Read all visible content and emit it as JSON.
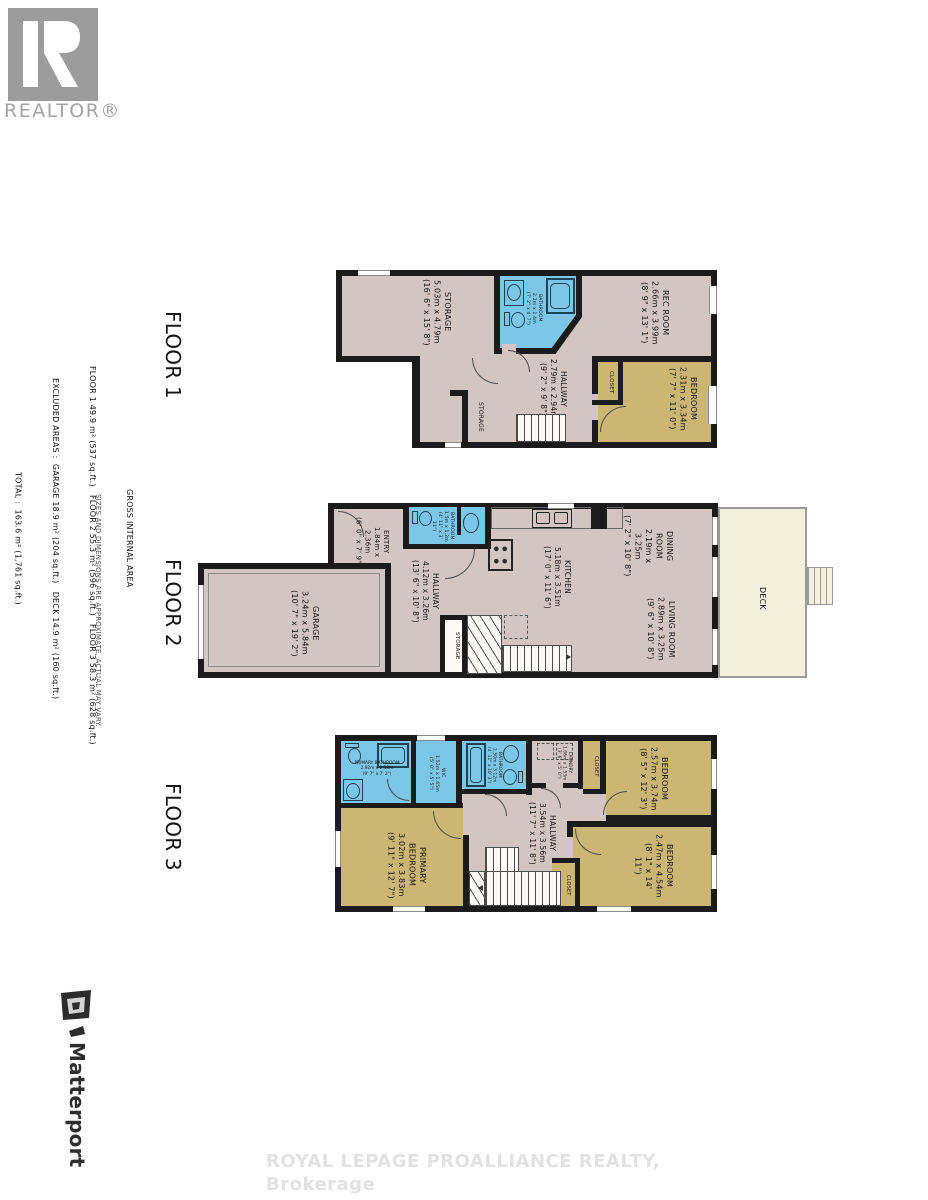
{
  "branding": {
    "realtor_text": "REALTOR®",
    "matterport_text": "Matterport",
    "watermark": "ROYAL LEPAGE PROALLIANCE REALTY, Brokerage"
  },
  "area_summary": {
    "title": "GROSS INTERNAL AREA",
    "floors_line": "FLOOR 1 49.9 m² (537 sq.ft.)   FLOOR 2 55.3 m² (596 sq.ft.)   FLOOR 3 58.3 m² (628 sq.ft.)",
    "excluded_line": "EXCLUDED AREAS :  GARAGE 18.9 m² (204 sq.ft.)   DECK 14.9 m² (160 sq.ft.)",
    "total_line": "TOTAL :  163.6 m² (1,761 sq.ft.)",
    "disclaimer": "SIZES AND DIMENSIONS ARE APPROXIMATE, ACTUAL MAY VARY."
  },
  "floor1": {
    "label": "FLOOR 1",
    "storage": {
      "name": "STORAGE",
      "metric": "5.03m x 4.79m",
      "imperial": "(16' 6\" x 15' 8\")"
    },
    "bathroom": {
      "name": "BATHROOM",
      "metric": "2.2m x 1.4m",
      "imperial": "(7' 2\" x 4' 7\")"
    },
    "rec_room": {
      "name": "REC ROOM",
      "metric": "2.66m x 3.99m",
      "imperial": "(8' 9\" x 13' 1\")"
    },
    "hallway": {
      "name": "HALLWAY",
      "metric": "2.79m x 2.94m",
      "imperial": "(9' 2\" x 9' 8\")"
    },
    "bedroom": {
      "name": "BEDROOM",
      "metric": "2.31m x 3.34m",
      "imperial": "(7' 7\" x 11' 0\")"
    },
    "closet": {
      "name": "CLOSET"
    },
    "understairs_storage": {
      "name": "STORAGE"
    }
  },
  "floor2": {
    "label": "FLOOR 2",
    "garage": {
      "name": "GARAGE",
      "metric": "3.24m x 5.84m",
      "imperial": "(10' 7\" x 19' 2\")"
    },
    "entry": {
      "name": "ENTRY",
      "metric": "1.84m x 2.36m",
      "imperial": "(6' 0\" x 7' 9\")"
    },
    "bathroom": {
      "name": "BATHROOM",
      "metric": "1.5m x 1.2m",
      "imperial": "(4' 11\" x 3' 11\")"
    },
    "hallway": {
      "name": "HALLWAY",
      "metric": "4.12m x 3.26m",
      "imperial": "(13' 6\" x 10' 8\")"
    },
    "kitchen": {
      "name": "KITCHEN",
      "metric": "5.18m x 3.51m",
      "imperial": "(17' 0\" x 11' 6\")"
    },
    "dining": {
      "line1": "DINING",
      "line2": "ROOM",
      "metric": "2.19m x 3.25m",
      "imperial": "(7' 2\" x 10' 8\")"
    },
    "living": {
      "name": "LIVING ROOM",
      "metric": "2.89m x 3.25m",
      "imperial": "(9' 6\" x 10' 8\")"
    },
    "storage": {
      "name": "STORAGE"
    },
    "deck": {
      "name": "DECK"
    }
  },
  "floor3": {
    "label": "FLOOR 3",
    "primary_bathroom": {
      "name": "PRIMARY BATHROOM",
      "metric": "2.92m x 2.18m",
      "imperial": "(9' 7\" x 7' 2\")"
    },
    "wic": {
      "name": "WIC",
      "metric": "1.52m x 1.65m",
      "imperial": "(5' 0\" x 5' 5\")"
    },
    "bathroom": {
      "name": "BATHROOM",
      "metric": "1.50m x 3.12m",
      "imperial": "(4' 11\" x 10' 3\")"
    },
    "laundry": {
      "name": "LAUNDRY",
      "metric": "1.06m x 1.53m",
      "imperial": "(3' 6\" x 5' 0\")"
    },
    "closet_top": {
      "name": "CLOSET"
    },
    "closet_bottom": {
      "name": "CLOSET"
    },
    "bedroom_upper": {
      "name": "BEDROOM",
      "metric": "2.57m x 3.74m",
      "imperial": "(8' 5\" x 12' 3\")"
    },
    "bedroom_lower": {
      "name": "BEDROOM",
      "metric": "2.47m x 4.54m",
      "imperial": "(8' 1\" x 14' 11\")"
    },
    "hallway": {
      "name": "HALLWAY",
      "metric": "3.54m x 3.56m",
      "imperial": "(11' 7\" x 11' 8\")"
    },
    "primary_bedroom": {
      "line1": "PRIMARY",
      "line2": "BEDROOM",
      "metric": "3.02m x 3.83m",
      "imperial": "(9' 11\" x 12' 7\")"
    }
  },
  "colors": {
    "floor_fill": "#d3c5c2",
    "bedroom_fill": "#cbb674",
    "bath_fill": "#7cc6e7",
    "deck_fill": "#f3f0dc",
    "wall": "#1b1b1b"
  }
}
